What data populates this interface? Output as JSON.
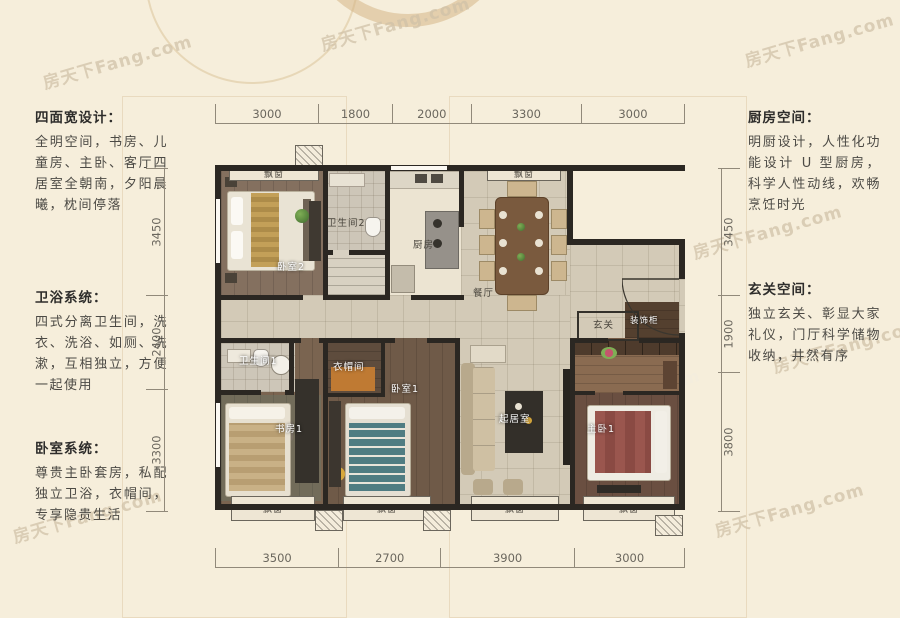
{
  "watermark": "房天下Fang.com",
  "left_panel": [
    {
      "title": "四面宽设计：",
      "body": "全明空间，书房、儿童房、主卧、客厅四居室全朝南，夕阳晨曦，枕间停落"
    },
    {
      "title": "卫浴系统：",
      "body": "四式分离卫生间，洗衣、洗浴、如厕、洗漱，互相独立，方便一起使用"
    },
    {
      "title": "卧室系统：",
      "body": "尊贵主卧套房，私配独立卫浴，衣帽间，专享隐贵生活"
    }
  ],
  "right_panel": [
    {
      "title": "厨房空间：",
      "body": "明厨设计，人性化功能设计 U 型厨房，科学人性动线，欢畅烹饪时光"
    },
    {
      "title": "玄关空间：",
      "body": "独立玄关、彰显大家礼仪，门厅科学储物收纳，井然有序"
    }
  ],
  "dimensions": {
    "top": [
      3000,
      1800,
      2000,
      3300,
      3000
    ],
    "bottom": [
      3500,
      2700,
      3900,
      3000
    ],
    "left": [
      3450,
      2400,
      3300
    ],
    "right": [
      3450,
      1900,
      3800
    ]
  },
  "rooms": {
    "bedroom2": "卧室2",
    "bathroom2": "卫生间2",
    "kitchen": "厨房",
    "dining": "餐厅",
    "foyer": "玄关",
    "deco_cabinet": "装饰柜",
    "bathroom1": "卫生间1",
    "study": "书房1",
    "closet": "衣帽间",
    "bedroom1": "卧室1",
    "living": "起居室",
    "master": "主卧1",
    "bay_window": "飘窗"
  }
}
